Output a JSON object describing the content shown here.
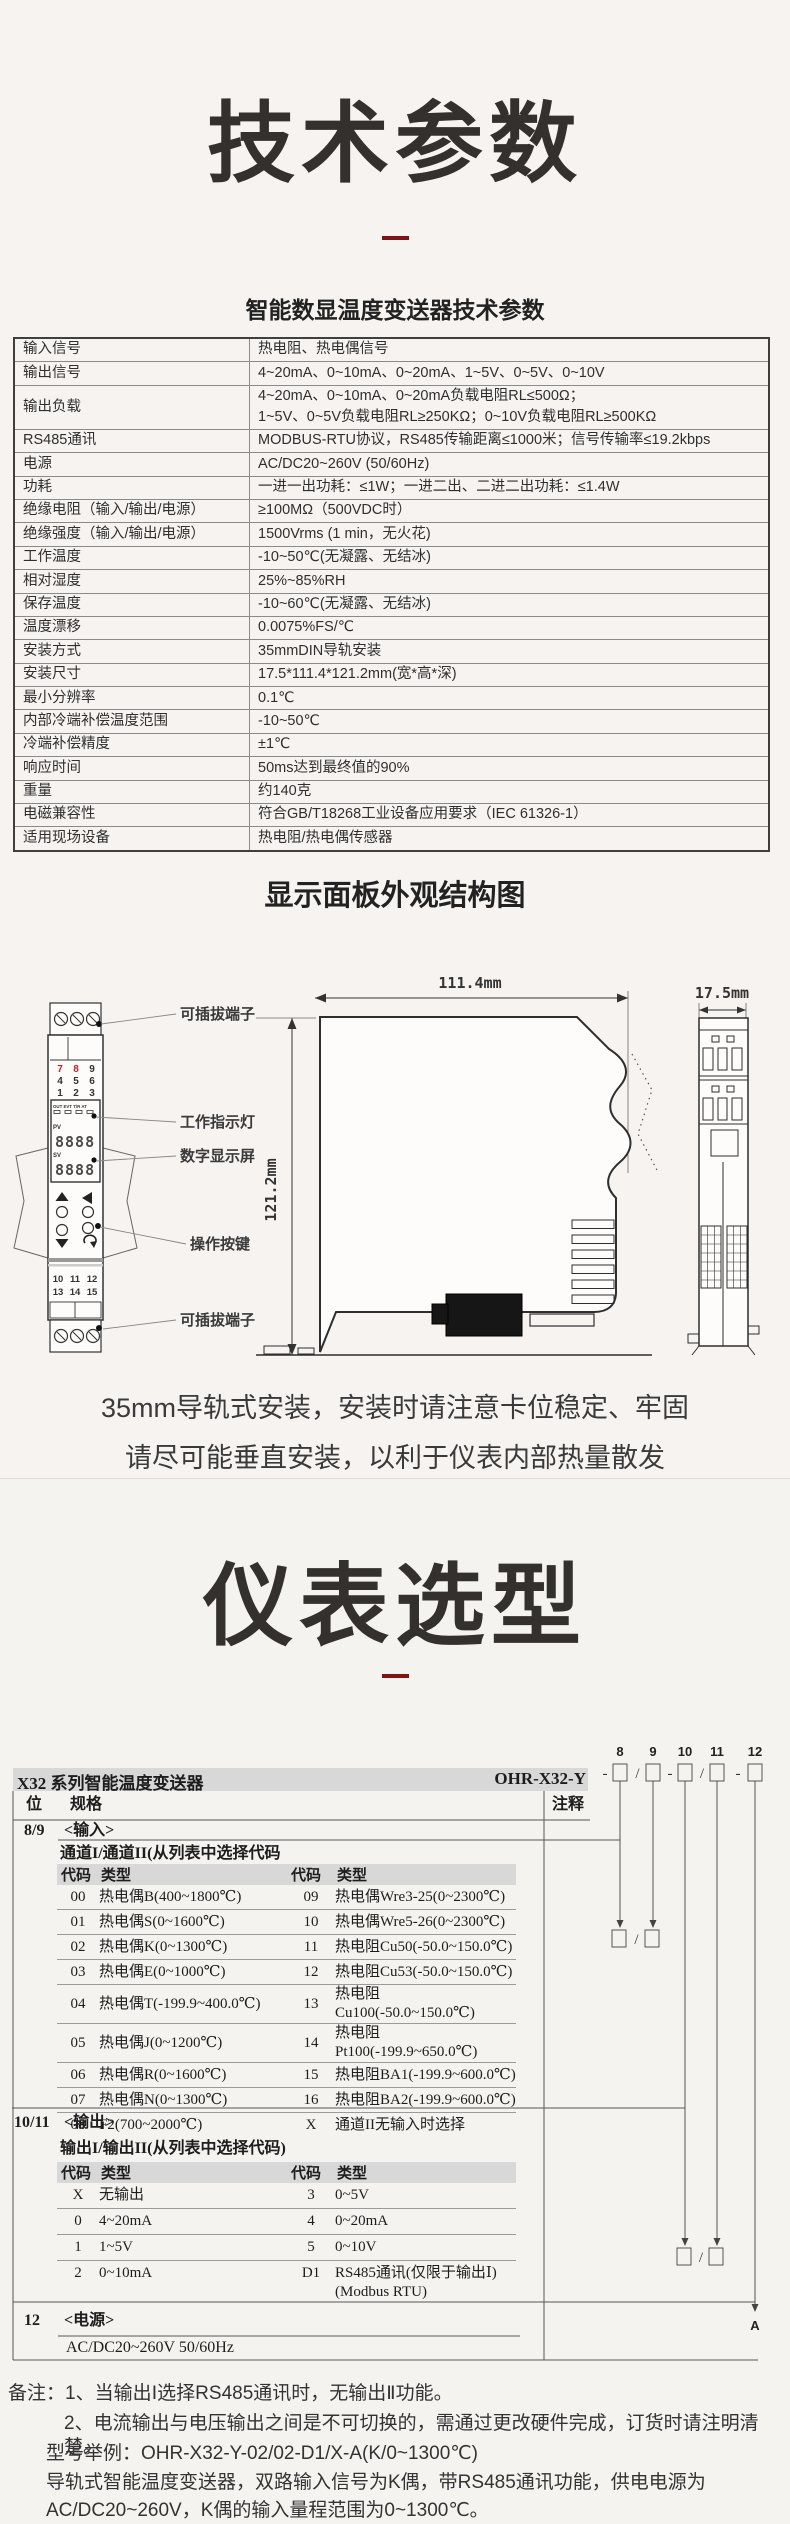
{
  "titles": {
    "tech": "技术参数",
    "select": "仪表选型"
  },
  "spec": {
    "title": "智能数显温度变送器技术参数",
    "rows": [
      {
        "label": "输入信号",
        "value": "热电阻、热电偶信号"
      },
      {
        "label": "输出信号",
        "value": "4~20mA、0~10mA、0~20mA、1~5V、0~5V、0~10V"
      },
      {
        "label": "输出负载",
        "value": "4~20mA、0~10mA、0~20mA负载电阻RL≤500Ω；\n1~5V、0~5V负载电阻RL≥250KΩ；0~10V负载电阻RL≥500KΩ"
      },
      {
        "label": "RS485通讯",
        "value": "MODBUS-RTU协议，RS485传输距离≤1000米；信号传输率≤19.2kbps"
      },
      {
        "label": "电源",
        "value": "AC/DC20~260V (50/60Hz)"
      },
      {
        "label": "功耗",
        "value": "一进一出功耗：≤1W；一进二出、二进二出功耗：≤1.4W"
      },
      {
        "label": "绝缘电阻（输入/输出/电源）",
        "value": "≥100MΩ（500VDC时）"
      },
      {
        "label": "绝缘强度（输入/输出/电源）",
        "value": "1500Vrms (1 min，无火花)"
      },
      {
        "label": "工作温度",
        "value": "-10~50℃(无凝露、无结冰)"
      },
      {
        "label": "相对湿度",
        "value": "25%~85%RH"
      },
      {
        "label": "保存温度",
        "value": "-10~60℃(无凝露、无结冰)"
      },
      {
        "label": "温度漂移",
        "value": "0.0075%FS/℃"
      },
      {
        "label": "安装方式",
        "value": "35mmDIN导轨安装"
      },
      {
        "label": "安装尺寸",
        "value": "17.5*111.4*121.2mm(宽*高*深)"
      },
      {
        "label": "最小分辨率",
        "value": "0.1℃"
      },
      {
        "label": "内部冷端补偿温度范围",
        "value": "-10~50℃"
      },
      {
        "label": "冷端补偿精度",
        "value": "±1℃"
      },
      {
        "label": "响应时间",
        "value": "50ms达到最终值的90%"
      },
      {
        "label": "重量",
        "value": "约140克"
      },
      {
        "label": "电磁兼容性",
        "value": "符合GB/T18268工业设备应用要求（IEC 61326-1）"
      },
      {
        "label": "适用现场设备",
        "value": "热电阻/热电偶传感器"
      }
    ]
  },
  "diagram": {
    "section_title": "显示面板外观结构图",
    "dim_width": "111.4mm",
    "dim_height": "121.2mm",
    "dim_depth": "17.5mm",
    "labels": {
      "terminal_top": "可插拔端子",
      "indicator": "工作指示灯",
      "display": "数字显示屏",
      "buttons": "操作按键",
      "terminal_bottom": "可插拔端子"
    },
    "panel": {
      "leds": "OUT EVT T/R AT",
      "pv": "PV",
      "pv_value": "8888",
      "sv": "SV",
      "sv_value": "8888",
      "t1": [
        "7",
        "8",
        "9"
      ],
      "t2": [
        "4",
        "5",
        "6"
      ],
      "t3": [
        "1",
        "2",
        "3"
      ],
      "b1": [
        "10",
        "11",
        "12"
      ],
      "b2": [
        "13",
        "14",
        "15"
      ]
    },
    "note1": "35mm导轨式安装，安装时请注意卡位稳定、牢固",
    "note2": "请尽可能垂直安装，以利于仪表内部热量散发"
  },
  "selection": {
    "product": "X32 系列智能温度变送器",
    "model": "OHR-X32-Y",
    "digits": [
      "8",
      "9",
      "10",
      "11",
      "12"
    ],
    "seps": [
      "-",
      "/",
      "-",
      "/",
      "-"
    ],
    "slash": "/",
    "headers": {
      "pos": "位",
      "spec": "规格",
      "note": "注释"
    },
    "code_h": "代码",
    "type_h": "类型",
    "input": {
      "pos": "8/9",
      "title": "<输入>",
      "subtitle": "通道I/通道II(从列表中选择代码",
      "rows": [
        [
          "00",
          "热电偶B(400~1800℃)",
          "09",
          "热电偶Wre3-25(0~2300℃)"
        ],
        [
          "01",
          "热电偶S(0~1600℃)",
          "10",
          "热电偶Wre5-26(0~2300℃)"
        ],
        [
          "02",
          "热电偶K(0~1300℃)",
          "11",
          "热电阻Cu50(-50.0~150.0℃)"
        ],
        [
          "03",
          "热电偶E(0~1000℃)",
          "12",
          "热电阻Cu53(-50.0~150.0℃)"
        ],
        [
          "04",
          "热电偶T(-199.9~400.0℃)",
          "13",
          "热电阻Cu100(-50.0~150.0℃)"
        ],
        [
          "05",
          "热电偶J(0~1200℃)",
          "14",
          "热电阻Pt100(-199.9~650.0℃)"
        ],
        [
          "06",
          "热电偶R(0~1600℃)",
          "15",
          "热电阻BA1(-199.9~600.0℃)"
        ],
        [
          "07",
          "热电偶N(0~1300℃)",
          "16",
          "热电阻BA2(-199.9~600.0℃)"
        ],
        [
          "08",
          "F2(700~2000℃)",
          "X",
          "通道II无输入时选择"
        ]
      ]
    },
    "output": {
      "pos": "10/11",
      "title": "<输出>",
      "subtitle": "输出I/输出II(从列表中选择代码)",
      "rows": [
        [
          "X",
          "无输出",
          "3",
          "0~5V"
        ],
        [
          "0",
          "4~20mA",
          "4",
          "0~20mA"
        ],
        [
          "1",
          "1~5V",
          "5",
          "0~10V"
        ],
        [
          "2",
          "0~10mA",
          "D1",
          "RS485通讯(仅限于输出Ⅰ)\n(Modbus RTU)"
        ]
      ]
    },
    "power": {
      "pos": "12",
      "title": "<电源>",
      "value": "AC/DC20~260V  50/60Hz"
    },
    "end_label": "A"
  },
  "notes": {
    "line1": "备注：1、当输出Ⅰ选择RS485通讯时，无输出Ⅱ功能。",
    "line2": "2、电流输出与电压输出之间是不可切换的，需通过更改硬件完成，订货时请注明清楚。",
    "line3": "型号举例：OHR-X32-Y-02/02-D1/X-A(K/0~1300℃)",
    "line4": "导轨式智能温度变送器，双路输入信号为K偶，带RS485通讯功能，供电电源为",
    "line5": "AC/DC20~260V，K偶的输入量程范围为0~1300℃。"
  }
}
